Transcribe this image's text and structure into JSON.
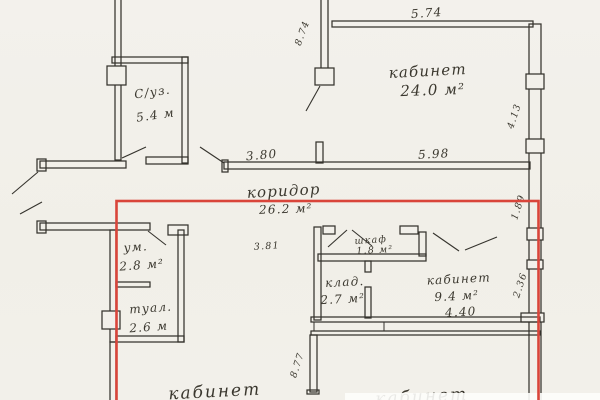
{
  "colors": {
    "paper": "#f2f0ea",
    "ink": "#35332d",
    "highlight": "#d9453a"
  },
  "rooms": {
    "office_top": {
      "name": "кабинет",
      "area": "24.0 м²"
    },
    "suz": {
      "name": "С/уз.",
      "area": "5.4 м"
    },
    "corridor": {
      "name": "коридор",
      "area": "26.2 м²"
    },
    "washroom": {
      "name": "ум.",
      "area": "2.8 м²"
    },
    "toilet": {
      "name": "туал.",
      "area": "2.6 м"
    },
    "wardrobe": {
      "name": "шкаф",
      "area": "1.8 м²"
    },
    "storage": {
      "name": "клад.",
      "area": "2.7 м²"
    },
    "office_mid": {
      "name": "кабинет",
      "area": "9.4 м²"
    },
    "office_bottom_left": {
      "name": "кабинет"
    },
    "office_bottom_right": {
      "name": "кабинет"
    }
  },
  "dimensions": {
    "top_width": "5.74",
    "left_height": "8.74",
    "right_window": "4.13",
    "corridor_left": "3.80",
    "corridor_right": "5.98",
    "right_mid": "1.89",
    "washroom_width": "3.81",
    "office_mid_width": "4.40",
    "right_lower": "2.36",
    "mid_wall_height": "8.77"
  }
}
